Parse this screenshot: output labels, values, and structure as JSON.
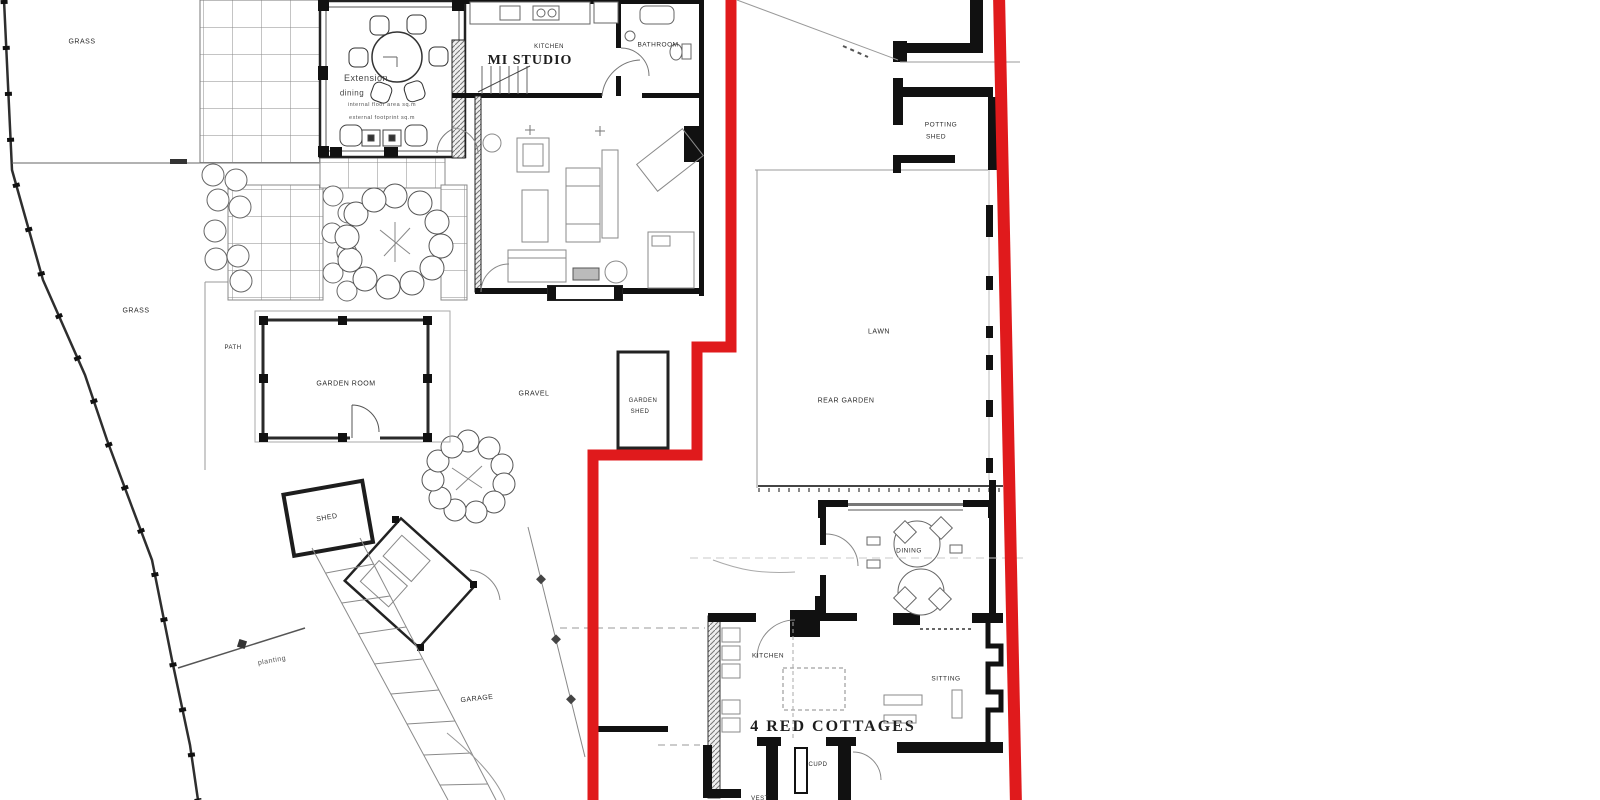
{
  "page": {
    "width": 1600,
    "height": 800,
    "background": "#ffffff",
    "description": "Scanned architectural site / floor plan with red property boundary line"
  },
  "colors": {
    "boundary_red": "#e01a1c",
    "ink": "#1b1b1b",
    "light_ink": "#777777"
  },
  "areas": {
    "grass_top": "GRASS",
    "grass_mid": "GRASS",
    "path": "PATH",
    "gravel": "GRAVEL",
    "lawn": "LAWN",
    "rear_garden": "REAR GARDEN",
    "planting": "planting"
  },
  "main_house": {
    "extension_title": "Extension",
    "extension_sub": "dining",
    "extension_note1": "internal floor area sq.m",
    "extension_note2": "external footprint sq.m",
    "kitchen": "KITCHEN",
    "studio": "MI STUDIO",
    "bathroom": "BATHROOM"
  },
  "outbuildings": {
    "garden_room": "GARDEN ROOM",
    "garden_shed_line1": "GARDEN",
    "garden_shed_line2": "SHED",
    "potting_shed_line1": "POTTING",
    "potting_shed_line2": "SHED",
    "shed": "SHED",
    "garage": "GARAGE"
  },
  "cottage": {
    "name": "4 RED COTTAGES",
    "dining": "DINING",
    "kitchen": "KITCHEN",
    "sitting": "SITTING",
    "cupd": "CUPD",
    "vest": "VEST"
  }
}
